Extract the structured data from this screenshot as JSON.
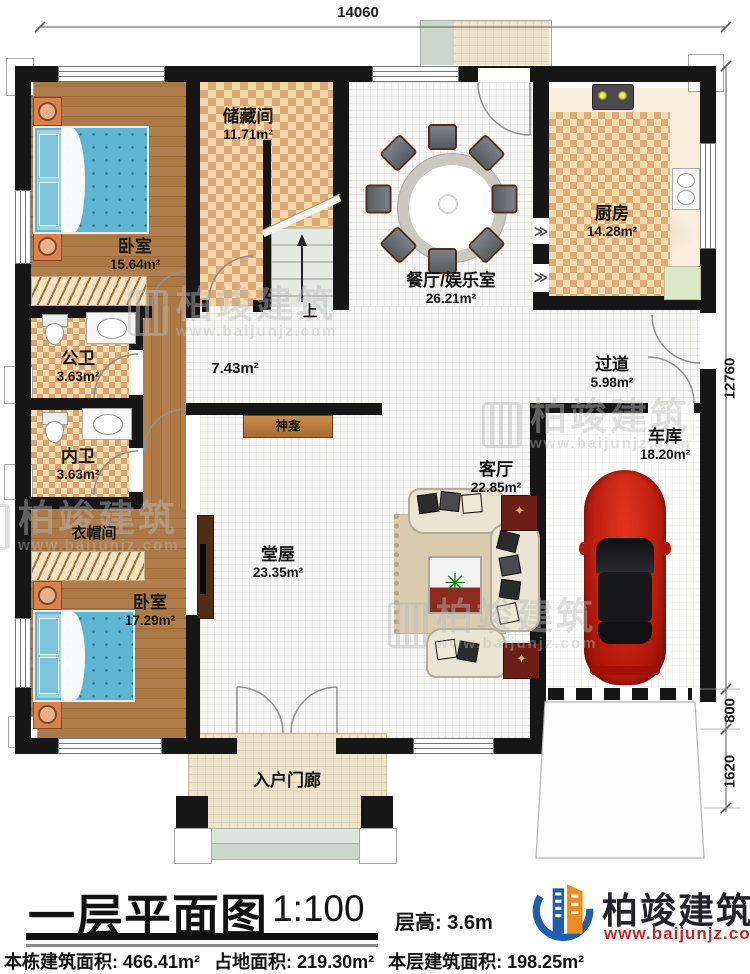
{
  "title_block": {
    "title": "一层平面图",
    "scale": "1:100",
    "floor_height": "层高: 3.6m",
    "stats": {
      "building_total": "本栋建筑面积: 466.41m²",
      "land": "占地面积: 219.30m²",
      "floor": "本层建筑面积: 198.25m²"
    }
  },
  "brand": {
    "name": "柏竣建筑",
    "url": "www.baijunjz.com"
  },
  "dimensions": {
    "top": "14060",
    "right_total": "12760",
    "right_mid": "800",
    "right_bottom": "1620"
  },
  "rooms": {
    "bedroom1": {
      "label": "卧室",
      "area": "15.64m²"
    },
    "storage": {
      "label": "储藏间",
      "area": "11.71m²"
    },
    "dining": {
      "label": "餐厅/娱乐室",
      "area": "26.21m²"
    },
    "kitchen": {
      "label": "厨房",
      "area": "14.28m²"
    },
    "public_bath": {
      "label": "公卫",
      "area": "3.63m²"
    },
    "private_bath": {
      "label": "内卫",
      "area": "3.63m²"
    },
    "corridor": {
      "area": "7.43m²"
    },
    "hallway": {
      "label": "过道",
      "area": "5.98m²"
    },
    "shrine": {
      "label": "神龛"
    },
    "hall": {
      "label": "堂屋",
      "area": "23.35m²"
    },
    "living": {
      "label": "客厅",
      "area": "22.85m²"
    },
    "garage": {
      "label": "车库",
      "area": "18.20m²"
    },
    "closet": {
      "label": "衣帽间"
    },
    "bedroom2": {
      "label": "卧室",
      "area": "17.29m²"
    },
    "porch": {
      "label": "入户门廊"
    },
    "stairs": {
      "label": "上"
    }
  }
}
